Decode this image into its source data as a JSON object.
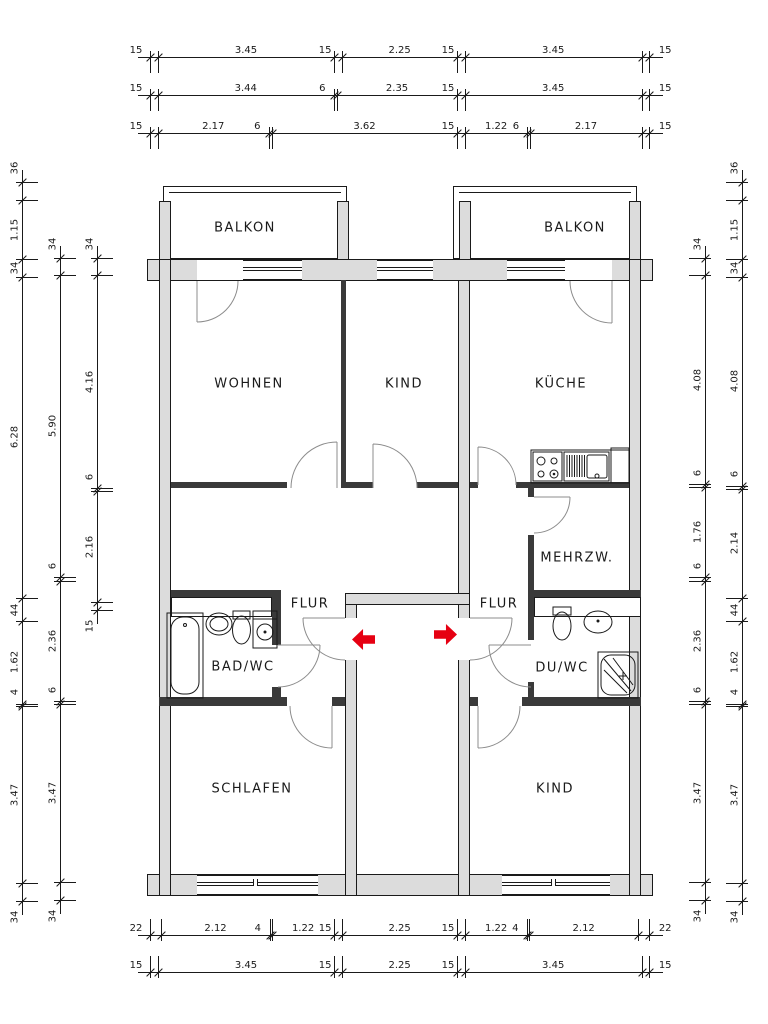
{
  "rooms": [
    {
      "id": "balkon-left",
      "label": "BALKON",
      "x": 245,
      "y": 228
    },
    {
      "id": "balkon-right",
      "label": "BALKON",
      "x": 575,
      "y": 228
    },
    {
      "id": "wohnen",
      "label": "WOHNEN",
      "x": 249,
      "y": 384
    },
    {
      "id": "kind-top",
      "label": "KIND",
      "x": 404,
      "y": 384
    },
    {
      "id": "kueche",
      "label": "KÜCHE",
      "x": 561,
      "y": 384
    },
    {
      "id": "mehrzweck",
      "label": "MEHRZW.",
      "x": 577,
      "y": 558
    },
    {
      "id": "flur-left",
      "label": "FLUR",
      "x": 310,
      "y": 604
    },
    {
      "id": "flur-right",
      "label": "FLUR",
      "x": 499,
      "y": 604
    },
    {
      "id": "bad-wc",
      "label": "BAD/WC",
      "x": 243,
      "y": 667
    },
    {
      "id": "du-wc",
      "label": "DU/WC",
      "x": 562,
      "y": 668
    },
    {
      "id": "schlafen",
      "label": "SCHLAFEN",
      "x": 252,
      "y": 789
    },
    {
      "id": "kind-bottom",
      "label": "KIND",
      "x": 555,
      "y": 789
    }
  ],
  "entrance_arrows": {
    "color": "#e60012",
    "left": {
      "x": 352,
      "y": 629
    },
    "right": {
      "x": 434,
      "y": 624
    }
  },
  "dimensions": {
    "scale_px_per_m": 51.2,
    "top": [
      {
        "line": 57,
        "origin": 150,
        "labels": [
          "15",
          "3.45",
          "15",
          "2.25",
          "15",
          "3.45",
          "15"
        ]
      },
      {
        "line": 95,
        "origin": 150,
        "labels": [
          "15",
          "3.44",
          "6",
          "2.35",
          "15",
          "3.45",
          "15"
        ]
      },
      {
        "line": 133,
        "origin": 150,
        "labels": [
          "15",
          "2.17",
          "6",
          "3.62",
          "15",
          "1.22",
          "6",
          "2.17",
          "15"
        ]
      }
    ],
    "bottom": [
      {
        "line": 935,
        "origin": 150,
        "labels": [
          "22",
          "2.12",
          "4",
          "1.22",
          "15",
          "2.25",
          "15",
          "1.22",
          "4",
          "2.12",
          "22"
        ]
      },
      {
        "line": 972,
        "origin": 150,
        "labels": [
          "15",
          "3.45",
          "15",
          "2.25",
          "15",
          "3.45",
          "15"
        ]
      }
    ],
    "left": [
      {
        "line": 22,
        "origin": 182,
        "labels": [
          "36",
          "1.15",
          "34",
          "6.28",
          "44",
          "1.62",
          "4",
          "3.47",
          "34"
        ]
      },
      {
        "line": 60,
        "origin": 258,
        "labels": [
          "34",
          "5.90",
          "6",
          "2.36",
          "6",
          "3.47",
          "34"
        ]
      },
      {
        "line": 97,
        "origin": 258,
        "labels": [
          "34",
          "4.16",
          "6",
          "2.16",
          "15"
        ]
      }
    ],
    "right": [
      {
        "line": 705,
        "origin": 258,
        "labels": [
          "34",
          "4.08",
          "6",
          "1.76",
          "6",
          "2.36",
          "6",
          "3.47",
          "34"
        ]
      },
      {
        "line": 742,
        "origin": 182,
        "labels": [
          "36",
          "1.15",
          "34",
          "4.08",
          "6",
          "2.14",
          "44",
          "1.62",
          "4",
          "3.47",
          "34"
        ]
      }
    ]
  },
  "colors": {
    "wall_fill": "#dcdcdc",
    "partition_fill": "#3a3a3a",
    "line": "#1a1a1a",
    "door_arc": "#8c8c8c"
  }
}
